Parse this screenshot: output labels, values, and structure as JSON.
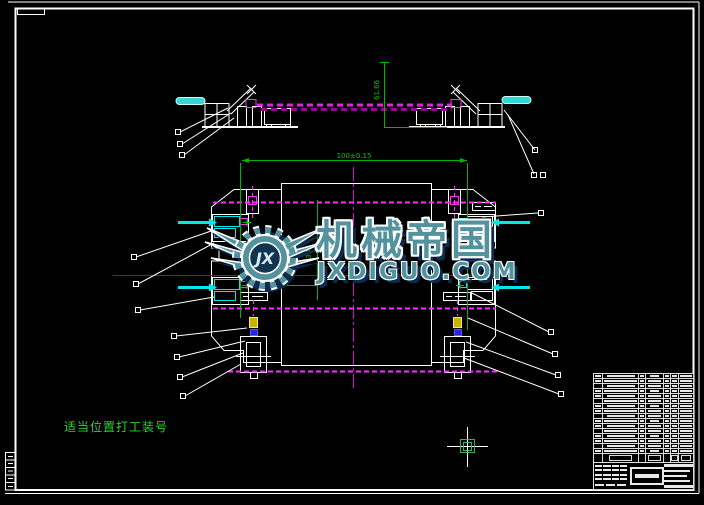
{
  "page": {
    "description": "CAD fixture drawing on black background (AutoCAD-style screenshot)",
    "background": "#000000"
  },
  "watermark": {
    "brand_text": "机械帝国",
    "domain_text": "JXDIGUO.COM",
    "logo_monogram": "JX",
    "fill_color": "#54929e",
    "outline_color": "#ffffff",
    "shadow_color": "#0d2b4e"
  },
  "drawing": {
    "note_bottom_left": "适当位置打工装号",
    "dimensions": {
      "top_width": "100±0.15",
      "top_view_height": "61.66",
      "side_height": "386"
    },
    "colors": {
      "outline_white": "#ffffff",
      "dimension_green": "#00c800",
      "note_green": "#2fd32f",
      "centerline_red": "#c80000",
      "centerline_magenta": "#e000e0",
      "chain_magenta": "#e81ee8",
      "clamp_cyan": "#00e8e8",
      "part_yellow": "#c8b400",
      "part_blue": "#2626dc",
      "cursor_grip_green": "#3fae5f"
    }
  },
  "title_block": {
    "bom_row_count": 17,
    "text_legible": false
  }
}
